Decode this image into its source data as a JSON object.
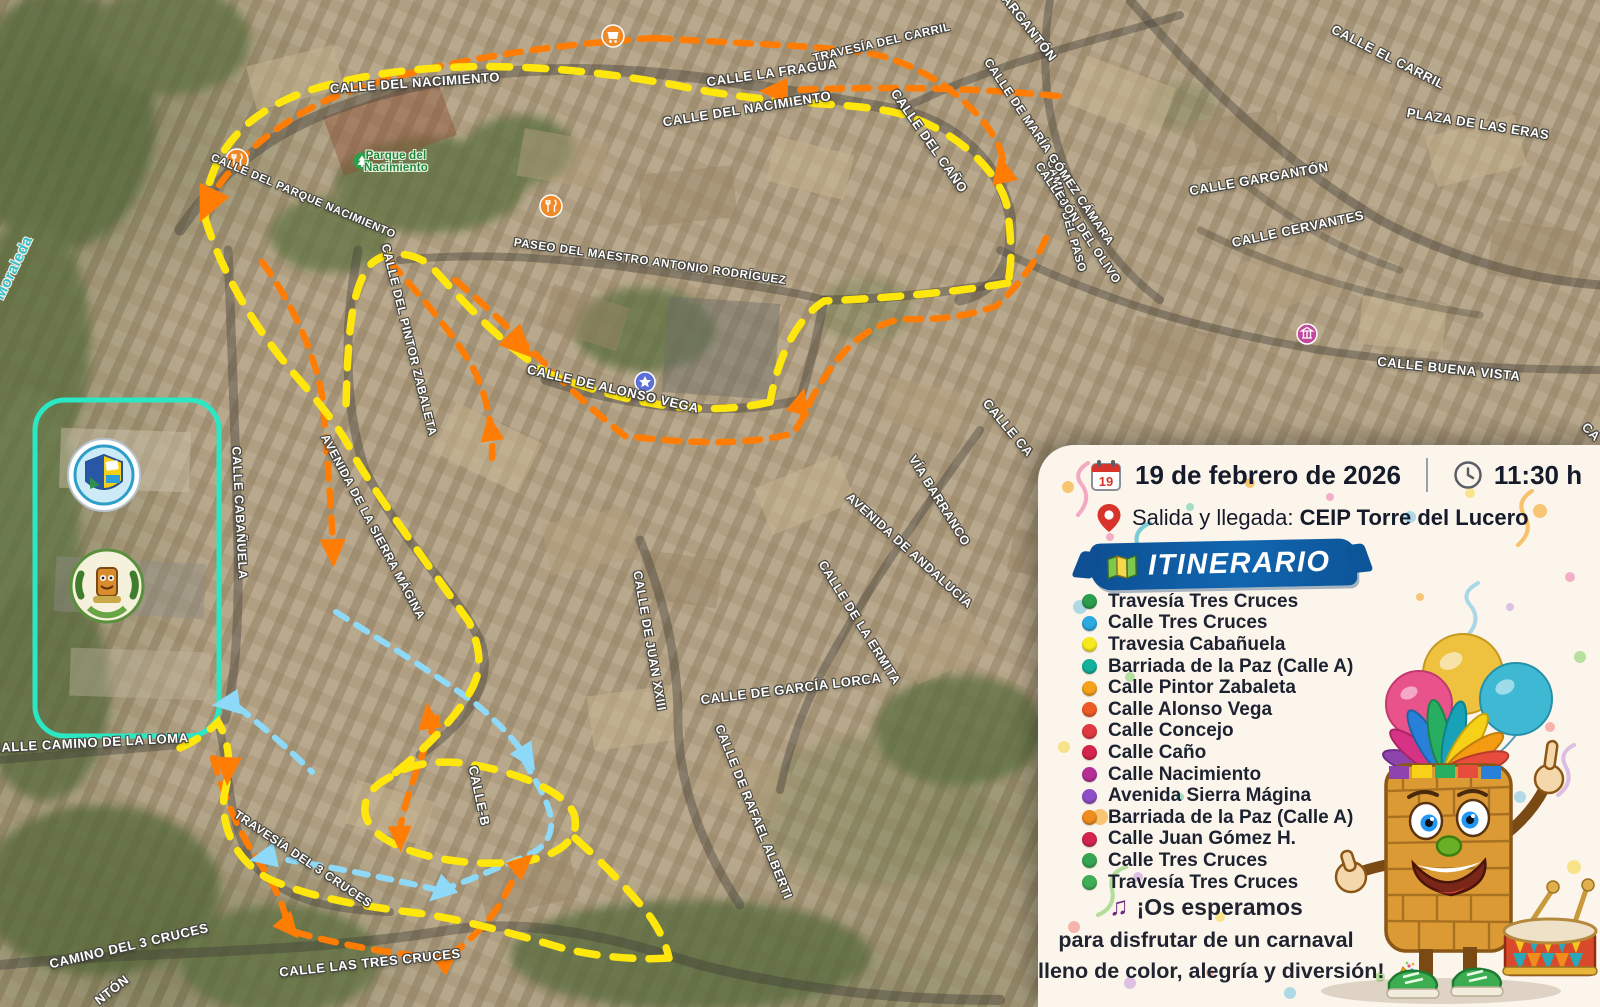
{
  "map": {
    "routes": {
      "main_route_color": "#ffe70e",
      "direction_route_color": "#ff7d05",
      "alt_route_color": "#8fd9f8",
      "school_highlight_color": "#2be8c4"
    },
    "street_labels": [
      {
        "text": "CALLE DEL NACIMIENTO",
        "x": 415,
        "y": 83,
        "r": -4
      },
      {
        "text": "CALLE DEL NACIMIENTO",
        "x": 747,
        "y": 109,
        "r": -9
      },
      {
        "text": "TRAVESÍA DEL CARRIL",
        "x": 882,
        "y": 43,
        "r": -13,
        "size": 11.5
      },
      {
        "text": "CALLE LA FRAGUA",
        "x": 772,
        "y": 73,
        "r": -8
      },
      {
        "text": "CALLE EL CARRIL",
        "x": 1388,
        "y": 57,
        "r": 27
      },
      {
        "text": "GARGANTÓN",
        "x": 1026,
        "y": 24,
        "r": 52
      },
      {
        "text": "CAMINO DEL PASO",
        "x": 1066,
        "y": 216,
        "r": 74,
        "size": 11.5
      },
      {
        "text": "PLAZA DE LAS ERAS",
        "x": 1478,
        "y": 124,
        "r": 9
      },
      {
        "text": "CALLE GARGANTÓN",
        "x": 1259,
        "y": 179,
        "r": -10
      },
      {
        "text": "CALLE CERVANTES",
        "x": 1298,
        "y": 229,
        "r": -12
      },
      {
        "text": "CALLE DE MARÍA GÓMEZ CÁMARA",
        "x": 1049,
        "y": 152,
        "r": 56,
        "size": 12
      },
      {
        "text": "CALLEJÓN DEL OLIVO",
        "x": 1078,
        "y": 223,
        "r": 56,
        "size": 12
      },
      {
        "text": "CALLE DEL CAÑO",
        "x": 929,
        "y": 141,
        "r": 55
      },
      {
        "text": "CALLE BUENA VISTA",
        "x": 1449,
        "y": 369,
        "r": 6
      },
      {
        "text": "PASEO DEL MAESTRO ANTONIO RODRÍGUEZ",
        "x": 650,
        "y": 262,
        "r": 8,
        "size": 11.5
      },
      {
        "text": "CALLE DEL PARQUE NACIMIENTO",
        "x": 303,
        "y": 197,
        "r": 23,
        "size": 11
      },
      {
        "text": "CALLE DE ALONSO VEGA",
        "x": 613,
        "y": 389,
        "r": 13
      },
      {
        "text": "CALLE DEL PINTOR ZABALETA",
        "x": 409,
        "y": 340,
        "r": 76,
        "size": 12
      },
      {
        "text": "AVENIDA DE LA SIERRA MÁGINA",
        "x": 373,
        "y": 527,
        "r": 62,
        "size": 12
      },
      {
        "text": "CALLE CABAÑUELA",
        "x": 239,
        "y": 513,
        "r": 87,
        "size": 12.5
      },
      {
        "text": "VÍA BARRANCO",
        "x": 939,
        "y": 501,
        "r": 58,
        "size": 12.5
      },
      {
        "text": "AVENIDA DE ANDALUCÍA",
        "x": 909,
        "y": 551,
        "r": 42,
        "size": 12.5
      },
      {
        "text": "CALLE DE LA ERMITA",
        "x": 859,
        "y": 623,
        "r": 58,
        "size": 12.5
      },
      {
        "text": "CALLE DE GARCÍA LORCA",
        "x": 791,
        "y": 689,
        "r": -7
      },
      {
        "text": "CALLE DE JUAN XXIII",
        "x": 649,
        "y": 641,
        "r": 80,
        "size": 12.5
      },
      {
        "text": "CALLE DE RAFAEL ALBERTI",
        "x": 753,
        "y": 812,
        "r": 68,
        "size": 12.5
      },
      {
        "text": "CALLE-B",
        "x": 479,
        "y": 796,
        "r": 78
      },
      {
        "text": "TRAVESÍA DEL 3 CRUCES",
        "x": 303,
        "y": 859,
        "r": 34,
        "size": 12
      },
      {
        "text": "CALLE LAS TRES CRUCES",
        "x": 370,
        "y": 963,
        "r": -6
      },
      {
        "text": "CAMINO DEL 3 CRUCES",
        "x": 129,
        "y": 946,
        "r": -13
      },
      {
        "text": "CALLE CAMINO DE LA LOMA",
        "x": 90,
        "y": 743,
        "r": -3
      },
      {
        "text": "NTÓN",
        "x": 112,
        "y": 990,
        "r": -38
      },
      {
        "text": "CALLE CA",
        "x": 1008,
        "y": 428,
        "r": 50
      },
      {
        "text": "CA",
        "x": 1591,
        "y": 432,
        "r": 45
      },
      {
        "text": "Moraleda",
        "x": 14,
        "y": 268,
        "r": -64,
        "cls": "loc",
        "size": 15
      },
      {
        "text": "Parque del\nNacimiento",
        "x": 396,
        "y": 162,
        "r": 0,
        "cls": "park",
        "size": 11.5
      }
    ]
  },
  "panel": {
    "header": {
      "date": "19 de febrero de 2026",
      "time": "11:30 h",
      "calendar_day": "19"
    },
    "location": {
      "label": "Salida y llegada:",
      "value": "CEIP Torre del Lucero"
    },
    "banner": {
      "title": "ITINERARIO"
    },
    "itinerary": {
      "items": [
        {
          "label": "Travesía Tres Cruces",
          "color": "#2a9d4e"
        },
        {
          "label": "Calle Tres Cruces",
          "color": "#2ba9e0"
        },
        {
          "label": "Travesia Cabañuela",
          "color": "#f6ea1e"
        },
        {
          "label": "Barriada de la Paz (Calle A)",
          "color": "#14b09a"
        },
        {
          "label": "Calle Pintor Zabaleta",
          "color": "#f5a21a"
        },
        {
          "label": "Calle Alonso Vega",
          "color": "#ee5a25"
        },
        {
          "label": "Calle Concejo",
          "color": "#e03a40"
        },
        {
          "label": "Calle Caño",
          "color": "#d5244b"
        },
        {
          "label": "Calle Nacimiento",
          "color": "#b52e96"
        },
        {
          "label": "Avenida Sierra Mágina",
          "color": "#8d4fc6"
        },
        {
          "label": "Barriada de la Paz (Calle A)",
          "color": "#f08c1e"
        },
        {
          "label": "Calle Juan Gómez H.",
          "color": "#d2244c"
        },
        {
          "label": "Calle Tres Cruces",
          "color": "#35a552"
        },
        {
          "label": "Travesía Tres Cruces",
          "color": "#3fae57"
        }
      ]
    },
    "closing": {
      "line1": "¡Os esperamos",
      "line2": "para disfrutar de un carnaval",
      "line3": "lleno de color, alegría y diversión!"
    }
  }
}
